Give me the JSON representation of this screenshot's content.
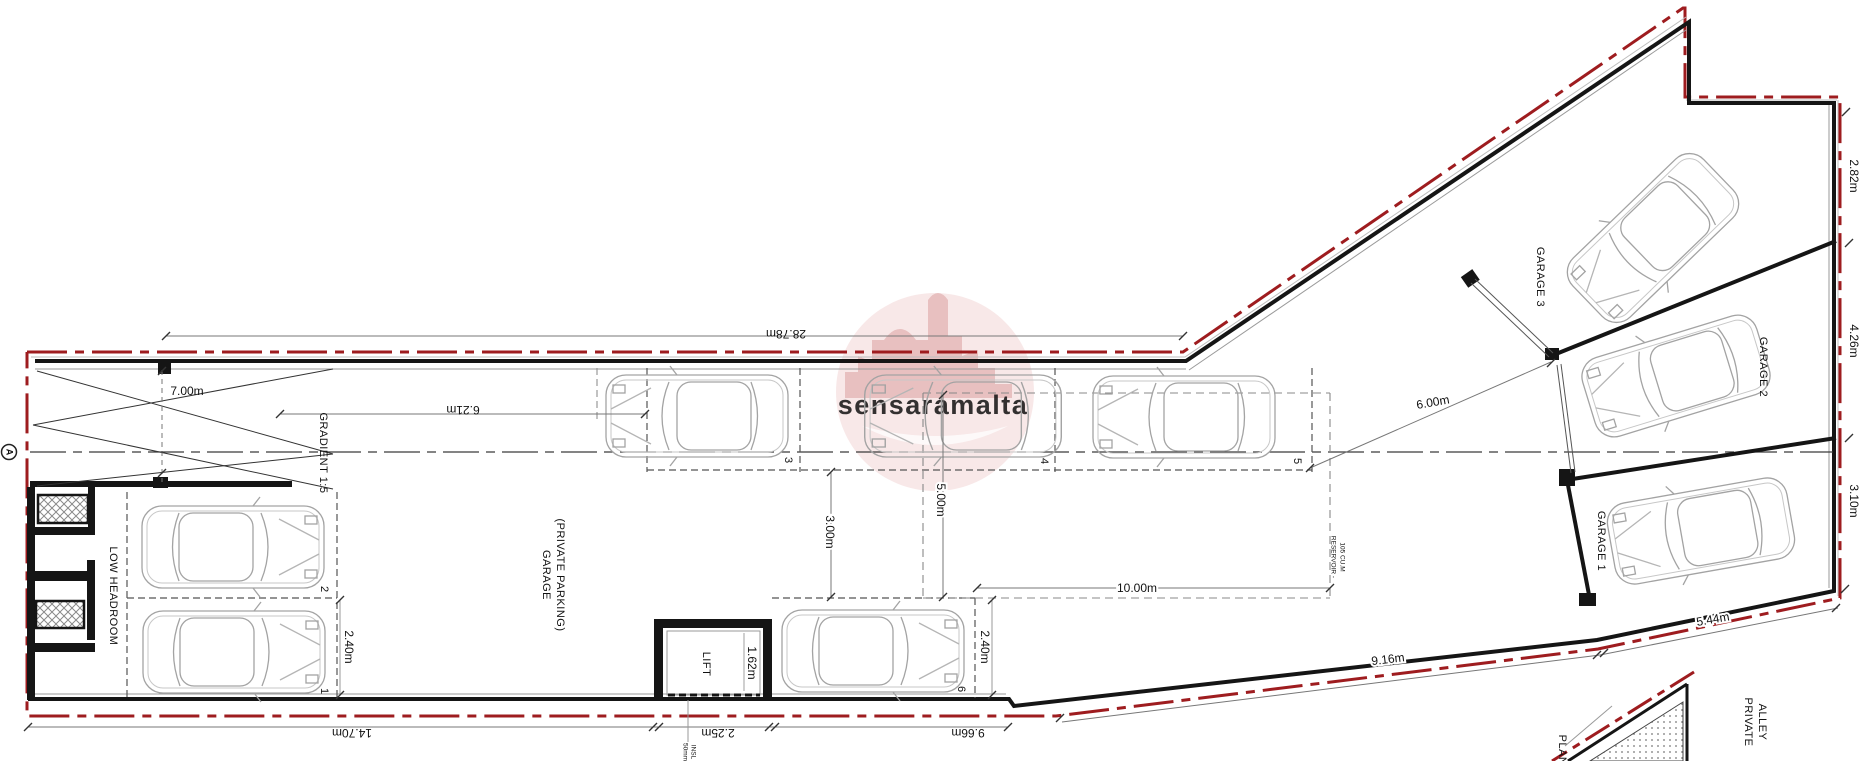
{
  "drawing": {
    "type": "architectural-garage-floor-plan",
    "section_marker": "A",
    "watermark": {
      "text": "sensaramalta"
    }
  },
  "labels": {
    "gradient": "GRADIENT 1:5",
    "low_headroom": "LOW HEADROOM",
    "garage_l1": "GARAGE",
    "garage_l2": "(PRIVATE PARKING)",
    "lift": "LIFT",
    "reservoir_l1": "RESERVOIR -",
    "reservoir_l2": "105 CU.M",
    "garage1": "GARAGE 1",
    "garage2": "GARAGE 2",
    "garage3": "GARAGE 3",
    "alley_l1": "PRIVATE",
    "alley_l2": "ALLEY",
    "plan": "PLAN"
  },
  "dimensions": {
    "ramp_width": "7.00m",
    "site_top": "28.78m",
    "ramp_length": "6.21m",
    "aisle_3m": "3.00m",
    "reservoir_depth": "5.00m",
    "bay1_width": "2.40m",
    "bay6_width": "2.40m",
    "reservoir_length": "10.00m",
    "aisle_6m": "6.00m",
    "right_top": "2.82m",
    "right_mid": "4.26m",
    "right_bottom": "3.10m",
    "bottom_right_outer": "5.44m",
    "bottom_right_inner": "9.16m",
    "bottom_left": "14.70m",
    "bottom_lift": "2.25m",
    "bottom_mid": "9.66m",
    "lift_width": "1.62m",
    "insl_a": "50mm",
    "insl_b": "INSL"
  },
  "bays": [
    {
      "number": "1"
    },
    {
      "number": "2"
    },
    {
      "number": "3"
    },
    {
      "number": "4"
    },
    {
      "number": "5"
    },
    {
      "number": "6"
    }
  ],
  "colors": {
    "boundary_red": "#9e1c1f",
    "wall_black": "#151515",
    "watermark_pink": "#eec7c7"
  }
}
